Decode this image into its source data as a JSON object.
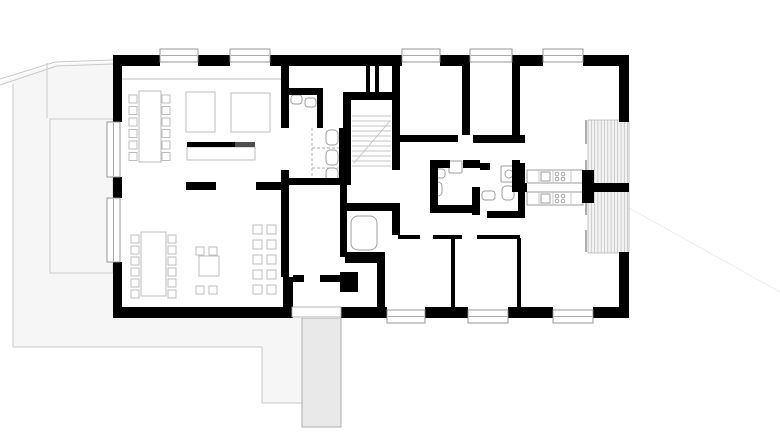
{
  "plan": {
    "canvas": {
      "w": 780,
      "h": 444,
      "bg": "#ffffff"
    },
    "colors": {
      "wall": "#000000",
      "counter_dark": "#4d4d4d",
      "furniture": "#bdbdbd",
      "fixture": "#9e9e9e",
      "glazing": "#8c8c8c",
      "stair": "#c4c4c4",
      "terrain_fill": "#f6f6f6",
      "terrain_line": "#c9c9c9",
      "faint_line": "#ececec",
      "path_fill": "#e9e9e9",
      "path_line": "#aeaeae",
      "deck_fill": "#f3f3f3",
      "deck_stripe": "#bcbcbc",
      "deck_line": "#b5b5b5",
      "floor": "#ffffff",
      "dash": "#a9a9a9"
    },
    "terrain": {
      "area": {
        "n": "terrain-area",
        "pts": [
          [
            0,
            82
          ],
          [
            55,
            64
          ],
          [
            113,
            62
          ],
          [
            113,
            318
          ],
          [
            302,
            318
          ],
          [
            302,
            403
          ],
          [
            262,
            403
          ],
          [
            262,
            347
          ],
          [
            13,
            347
          ],
          [
            13,
            84
          ]
        ]
      },
      "lines": [
        {
          "n": "retaining-wall-line",
          "pts": [
            [
              0,
              79
            ],
            [
              55,
              62
            ],
            [
              113,
              60
            ]
          ]
        },
        {
          "n": "retaining-wall-line",
          "pts": [
            [
              0,
              85
            ],
            [
              57,
              66
            ],
            [
              113,
              64
            ]
          ]
        },
        {
          "n": "terrain-line",
          "pts": [
            [
              47,
              63
            ],
            [
              47,
              118
            ]
          ]
        },
        {
          "n": "terrain-line",
          "pts": [
            [
              13,
              84
            ],
            [
              13,
              347
            ]
          ]
        },
        {
          "n": "terrain-line",
          "pts": [
            [
              13,
              347
            ],
            [
              262,
              347
            ]
          ]
        },
        {
          "n": "terrain-line",
          "pts": [
            [
              262,
              347
            ],
            [
              262,
              403
            ]
          ]
        },
        {
          "n": "terrain-line",
          "pts": [
            [
              262,
              403
            ],
            [
              302,
              403
            ]
          ]
        },
        {
          "n": "terrain-line-faint",
          "pts": [
            [
              629,
              208
            ],
            [
              780,
              292
            ]
          ],
          "c": "faint_line"
        }
      ],
      "terrace": [
        50,
        119,
        63,
        154
      ],
      "path": [
        302,
        318,
        39,
        109
      ]
    },
    "building": {
      "floor": [
        113,
        55,
        516,
        263
      ],
      "deck": {
        "r": [
          588,
          120,
          41,
          133
        ],
        "step": 3.3
      },
      "glass": [
        [
          586,
          120,
          586,
          144
        ],
        [
          586,
          160,
          586,
          183
        ],
        [
          586,
          192,
          586,
          215
        ],
        [
          586,
          230,
          586,
          252
        ]
      ],
      "beam": [
        [
          122,
          79
        ],
        [
          281,
          79
        ]
      ],
      "walls": [
        [
          113,
          55,
          47,
          11
        ],
        [
          198,
          55,
          32,
          11
        ],
        [
          270,
          55,
          132,
          11
        ],
        [
          440,
          55,
          30,
          11
        ],
        [
          512,
          55,
          31,
          11
        ],
        [
          583,
          55,
          46,
          11
        ],
        [
          113,
          307,
          179,
          11
        ],
        [
          341,
          307,
          46,
          11
        ],
        [
          425,
          307,
          43,
          11
        ],
        [
          508,
          307,
          45,
          11
        ],
        [
          593,
          307,
          36,
          11
        ],
        [
          113,
          55,
          9,
          67
        ],
        [
          113,
          177,
          9,
          21
        ],
        [
          113,
          262,
          9,
          56
        ],
        [
          619,
          55,
          10,
          67
        ],
        [
          619,
          252,
          10,
          66
        ],
        [
          281,
          66,
          8,
          62
        ],
        [
          281,
          170,
          8,
          107
        ],
        [
          283,
          277,
          10,
          41
        ],
        [
          293,
          275,
          11,
          7
        ],
        [
          320,
          275,
          25,
          7
        ],
        [
          186,
          182,
          30,
          8
        ],
        [
          256,
          182,
          31,
          8
        ],
        [
          285,
          88,
          38,
          7
        ],
        [
          317,
          95,
          6,
          33
        ],
        [
          339,
          128,
          7,
          57
        ],
        [
          289,
          178,
          54,
          7
        ],
        [
          343,
          92,
          57,
          8
        ],
        [
          343,
          100,
          8,
          85
        ],
        [
          392,
          66,
          8,
          104
        ],
        [
          366,
          66,
          4,
          26
        ],
        [
          375,
          66,
          4,
          26
        ],
        [
          340,
          185,
          7,
          26
        ],
        [
          340,
          203,
          60,
          8
        ],
        [
          340,
          211,
          7,
          46
        ],
        [
          392,
          211,
          8,
          24
        ],
        [
          345,
          252,
          40,
          11
        ],
        [
          377,
          263,
          8,
          44
        ],
        [
          340,
          272,
          18,
          20
        ],
        [
          398,
          135,
          60,
          7
        ],
        [
          473,
          135,
          52,
          8
        ],
        [
          462,
          66,
          8,
          69
        ],
        [
          512,
          66,
          8,
          72
        ],
        [
          512,
          160,
          8,
          28
        ],
        [
          512,
          183,
          15,
          9
        ],
        [
          582,
          170,
          12,
          33
        ],
        [
          594,
          183,
          35,
          9
        ],
        [
          430,
          160,
          20,
          8
        ],
        [
          463,
          160,
          17,
          8
        ],
        [
          430,
          160,
          8,
          50
        ],
        [
          430,
          205,
          50,
          8
        ],
        [
          472,
          187,
          8,
          28
        ],
        [
          480,
          163,
          10,
          7
        ],
        [
          518,
          163,
          7,
          54
        ],
        [
          487,
          211,
          38,
          7
        ],
        [
          398,
          235,
          22,
          4
        ],
        [
          433,
          235,
          29,
          4
        ],
        [
          477,
          235,
          43,
          4
        ],
        [
          451,
          238,
          4,
          69
        ],
        [
          517,
          238,
          4,
          69
        ]
      ],
      "counter_bar": {
        "black": [
          187,
          142,
          48,
          5
        ],
        "dark": [
          235,
          142,
          20,
          5
        ]
      },
      "windows": [
        {
          "r": [
            160,
            49,
            38,
            13
          ],
          "o": "h"
        },
        {
          "r": [
            230,
            49,
            40,
            13
          ],
          "o": "h"
        },
        {
          "r": [
            402,
            49,
            38,
            13
          ],
          "o": "h"
        },
        {
          "r": [
            470,
            49,
            42,
            13
          ],
          "o": "h"
        },
        {
          "r": [
            543,
            49,
            40,
            13
          ],
          "o": "h"
        },
        {
          "r": [
            387,
            310,
            38,
            13
          ],
          "o": "h"
        },
        {
          "r": [
            468,
            310,
            40,
            13
          ],
          "o": "h"
        },
        {
          "r": [
            553,
            310,
            40,
            13
          ],
          "o": "h"
        },
        {
          "r": [
            107,
            122,
            13,
            55
          ],
          "o": "v"
        },
        {
          "r": [
            107,
            198,
            13,
            64
          ],
          "o": "v"
        }
      ],
      "entrance": [
        292,
        307,
        49,
        10
      ],
      "stairs": {
        "x1": 352,
        "x2": 391,
        "y0": 116,
        "step": 5,
        "count": 11,
        "diag": [
          354,
          163,
          390,
          121
        ]
      },
      "counters": [
        [
          527,
          170,
          56,
          13
        ],
        [
          527,
          192,
          56,
          13
        ]
      ],
      "dashes": [
        [
          312,
          128,
          312,
          180
        ],
        [
          312,
          148,
          339,
          148
        ],
        [
          312,
          168,
          339,
          168
        ]
      ]
    },
    "furniture": {
      "items": [
        {
          "n": "long-table",
          "r": [
            139,
            91,
            22,
            71
          ]
        },
        {
          "n": "table",
          "r": [
            186,
            92,
            29,
            40
          ]
        },
        {
          "n": "table",
          "r": [
            231,
            93,
            39,
            39
          ]
        },
        {
          "n": "sideboard",
          "r": [
            187,
            147,
            68,
            13
          ]
        },
        {
          "n": "long-table",
          "r": [
            141,
            232,
            25,
            64
          ]
        },
        {
          "n": "square-table",
          "r": [
            199,
            256,
            20,
            20
          ]
        }
      ],
      "chair_size": 8,
      "chair_groups": [
        {
          "n": "chair-row",
          "x": 129,
          "y": 95,
          "dx": 0,
          "dy": 11.5,
          "cols": 1,
          "count": 6
        },
        {
          "n": "chair-row",
          "x": 162,
          "y": 95,
          "dx": 0,
          "dy": 11.5,
          "cols": 1,
          "count": 6
        },
        {
          "n": "chair-row",
          "x": 131,
          "y": 235,
          "dx": 0,
          "dy": 11,
          "cols": 1,
          "count": 6
        },
        {
          "n": "chair-row",
          "x": 168,
          "y": 235,
          "dx": 0,
          "dy": 11,
          "cols": 1,
          "count": 6
        },
        {
          "n": "lounge-chairs",
          "x": 253,
          "y": 225,
          "dx": 14,
          "dy": 15,
          "cols": 2,
          "count": 10,
          "size": 9
        }
      ],
      "single_chairs": [
        [
          196,
          247
        ],
        [
          209,
          247
        ],
        [
          196,
          286
        ],
        [
          209,
          286
        ]
      ]
    },
    "fixtures": {
      "rounded": [
        {
          "n": "toilet",
          "r": [
            326,
            130,
            12,
            15
          ],
          "rx": 4
        },
        {
          "n": "toilet",
          "r": [
            326,
            150,
            12,
            15
          ],
          "rx": 4
        },
        {
          "n": "toilet",
          "r": [
            326,
            168,
            12,
            15
          ],
          "rx": 4
        },
        {
          "n": "toilet",
          "r": [
            431,
            182,
            11,
            14
          ],
          "rx": 4
        },
        {
          "n": "toilet",
          "r": [
            502,
            186,
            12,
            14
          ],
          "rx": 4
        },
        {
          "n": "sink",
          "r": [
            291,
            95,
            11,
            9
          ],
          "rx": 3
        },
        {
          "n": "sink",
          "r": [
            305,
            98,
            11,
            9
          ],
          "rx": 3
        },
        {
          "n": "sink",
          "r": [
            433,
            169,
            12,
            9
          ],
          "rx": 3
        },
        {
          "n": "sink",
          "r": [
            482,
            191,
            13,
            9
          ],
          "rx": 3
        },
        {
          "n": "washing-machine",
          "r": [
            449,
            161,
            13,
            12
          ],
          "rx": 1
        },
        {
          "n": "shower",
          "r": [
            501,
            166,
            16,
            16
          ],
          "rx": 1
        },
        {
          "n": "elevator-cabin",
          "r": [
            351,
            216,
            26,
            34
          ],
          "rx": 7
        }
      ],
      "circles": [
        {
          "n": "shower-drain",
          "c": [
            509,
            174
          ],
          "rad": 4
        }
      ]
    }
  }
}
